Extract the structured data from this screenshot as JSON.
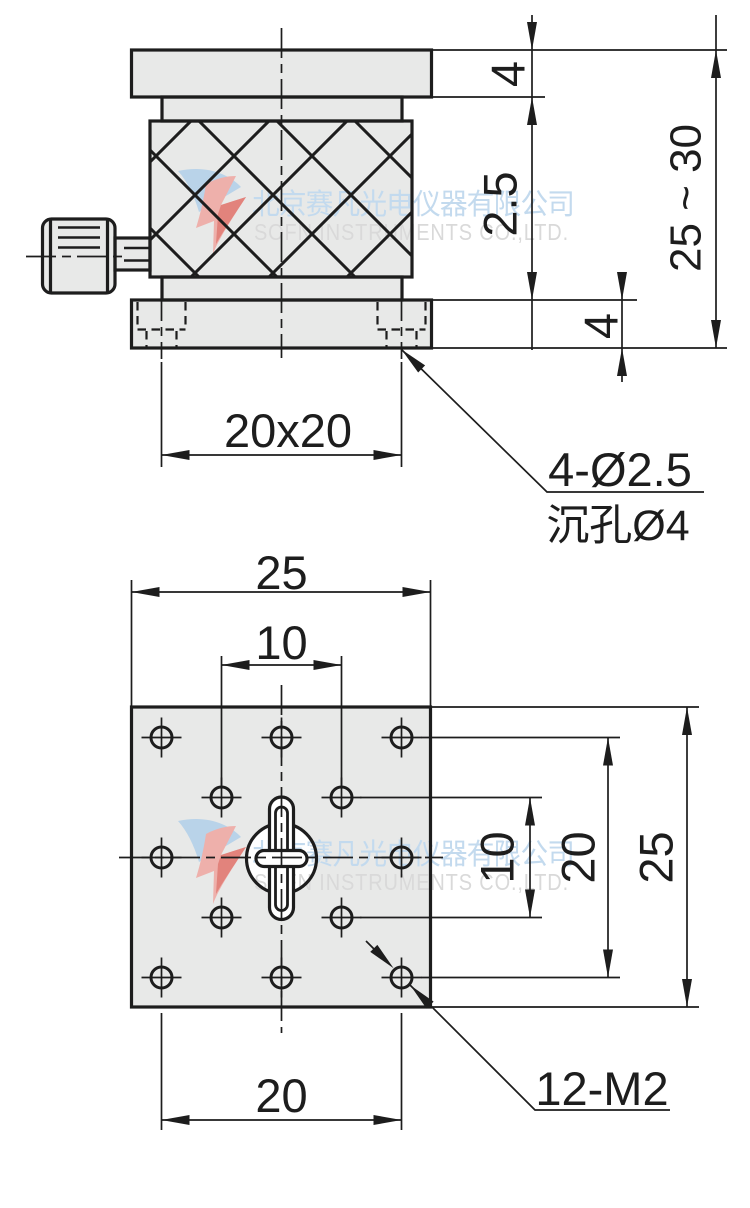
{
  "page": {
    "background": "#ffffff"
  },
  "colors": {
    "line": "#1d1d1d",
    "part_fill": "#e8e9e8",
    "white": "#ffffff",
    "watermark_cn": "#c3daee",
    "watermark_en": "#d9d9d9",
    "logo_blue": "#b9d3e9",
    "logo_pink": "#eeb0ab",
    "logo_red": "#e2837c"
  },
  "watermark": {
    "company_cn": "北京赛凡光电仪器有限公司",
    "company_en": "SOFN INSTRUMENTS CO.,LTD."
  },
  "top_view": {
    "dim_top_plate_thickness": "4",
    "dim_travel": "2.5",
    "dim_bottom_plate_thickness": "4",
    "dim_overall_height": "25 ~ 30",
    "dim_base_hole_pattern": "20x20",
    "callout_hole_line1": "4-Ø2.5",
    "callout_hole_line2": "沉孔Ø4"
  },
  "bottom_view": {
    "dim_plate_width": "25",
    "dim_inner_hole_spacing_h": "10",
    "dim_inner_hole_spacing_v": "10",
    "dim_outer_hole_spacing_v": "20",
    "dim_plate_height": "25",
    "dim_outer_hole_spacing_h": "20",
    "callout_tapped_holes": "12-M2"
  }
}
